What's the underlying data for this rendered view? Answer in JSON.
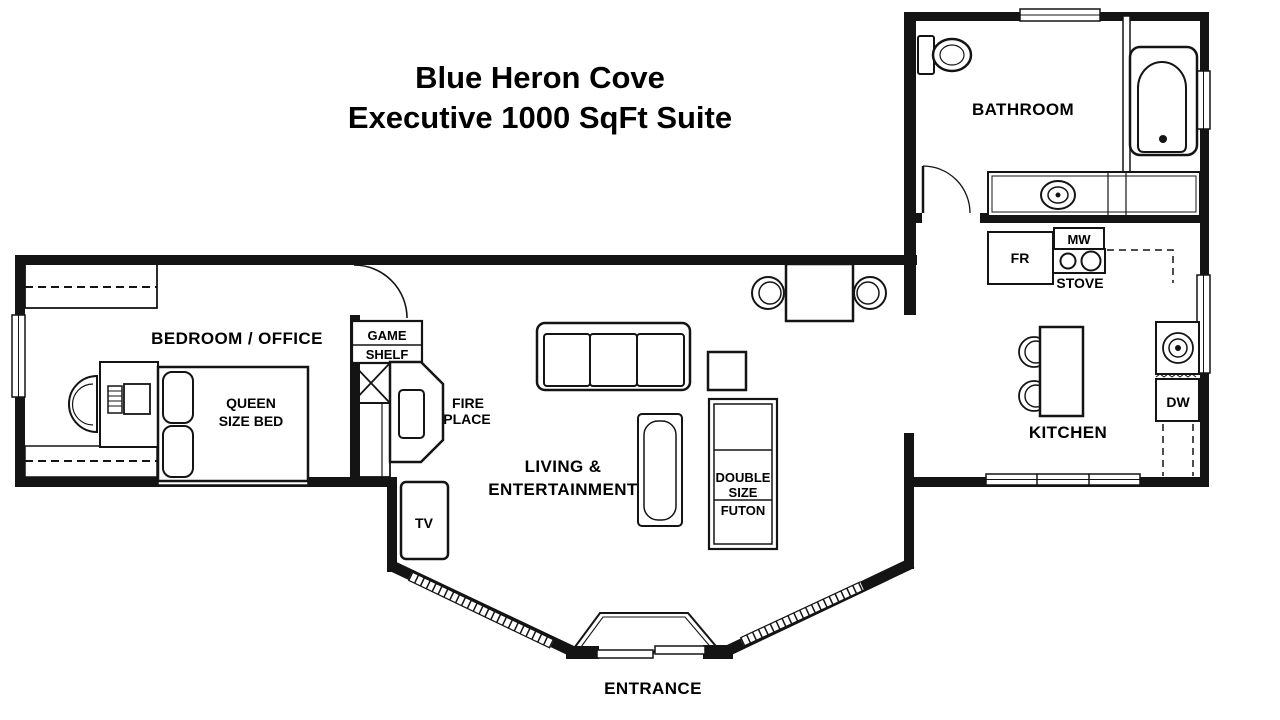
{
  "title": {
    "line1": "Blue Heron Cove",
    "line2": "Executive 1000 SqFt Suite"
  },
  "rooms": {
    "bathroom": "BATHROOM",
    "bedroom_office": "BEDROOM / OFFICE",
    "living_line1": "LIVING &",
    "living_line2": "ENTERTAINMENT",
    "kitchen": "KITCHEN",
    "entrance": "ENTRANCE"
  },
  "furniture": {
    "queen_bed_line1": "QUEEN",
    "queen_bed_line2": "SIZE BED",
    "game_shelf_line1": "GAME",
    "game_shelf_line2": "SHELF",
    "fireplace_line1": "FIRE",
    "fireplace_line2": "PLACE",
    "tv": "TV",
    "futon_line1": "DOUBLE",
    "futon_line2": "SIZE",
    "futon_line3": "FUTON",
    "fridge": "FR",
    "microwave": "MW",
    "stove": "STOVE",
    "dishwasher": "DW"
  },
  "colors": {
    "line": "#141414",
    "background": "#ffffff",
    "text": "#000000"
  }
}
